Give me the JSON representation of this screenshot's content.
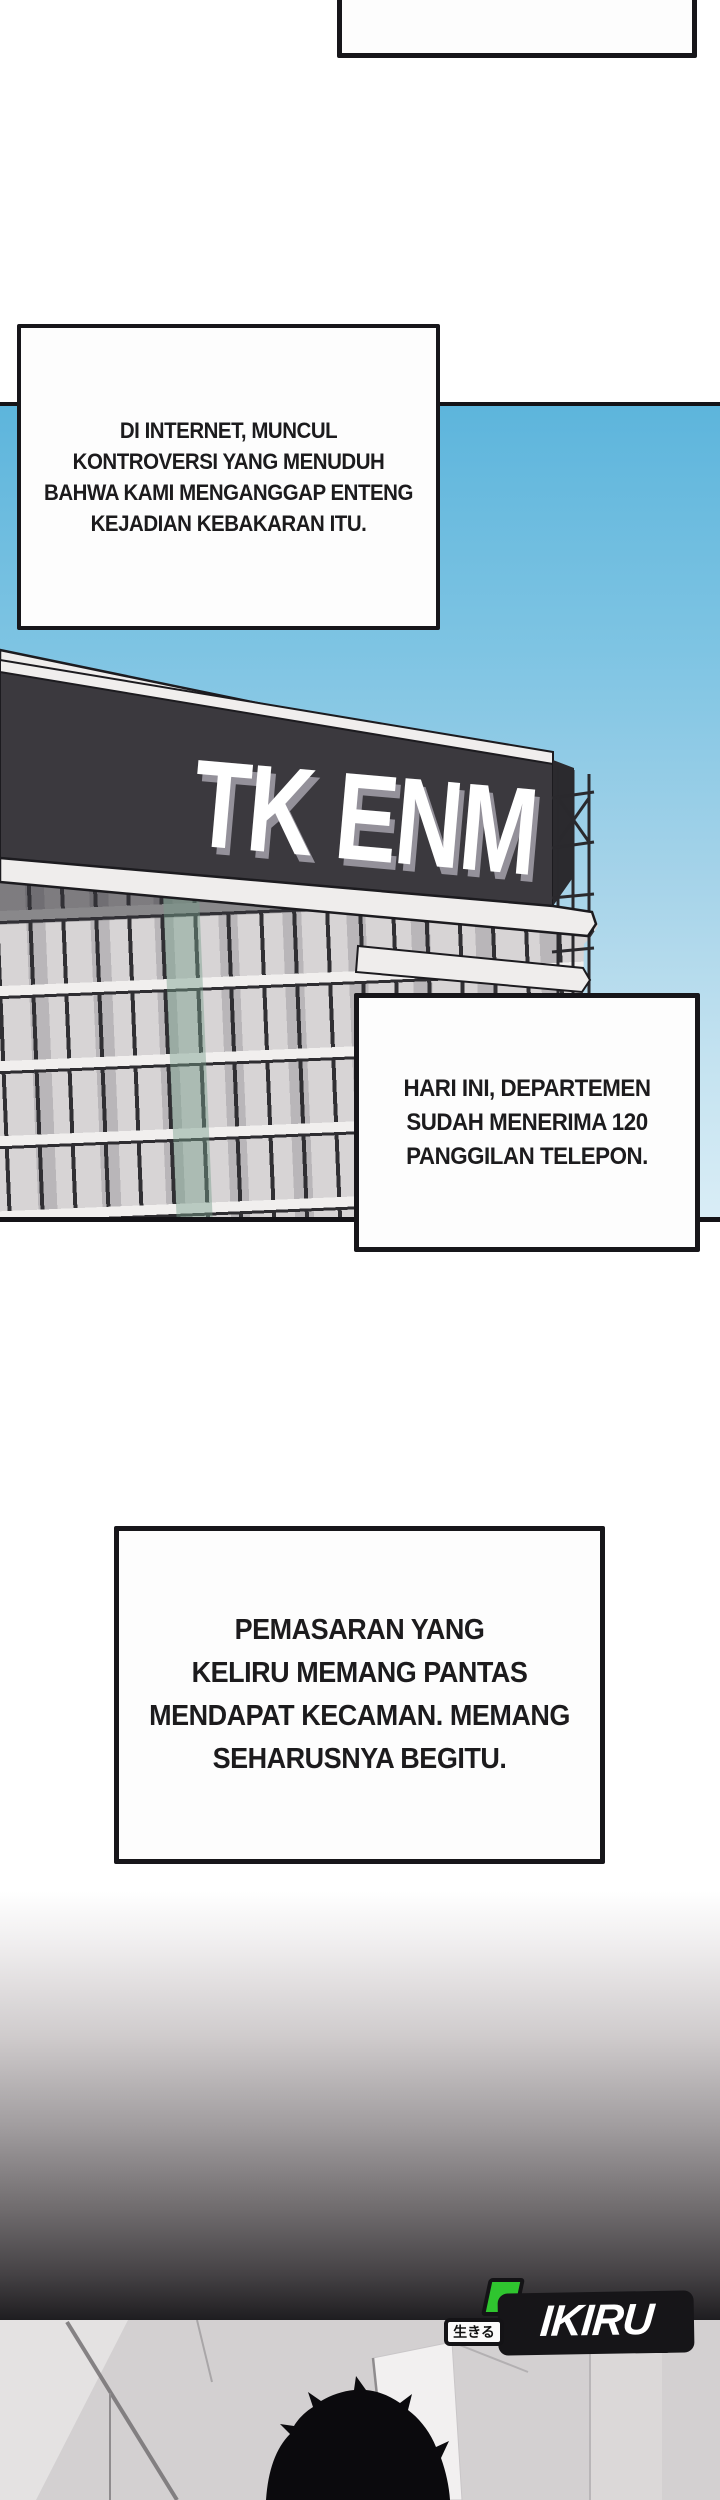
{
  "page": {
    "kind": "webtoon-comic-page"
  },
  "narration": {
    "bubble1": {
      "lines": [
        "DI INTERNET, MUNCUL",
        "KONTROVERSI YANG MENUDUH",
        "BAHWA KAMI MENGANGGAP ENTENG",
        "KEJADIAN KEBAKARAN ITU."
      ]
    },
    "bubble2": {
      "lines": [
        "HARI INI, DEPARTEMEN",
        "SUDAH MENERIMA 120",
        "PANGGILAN TELEPON."
      ]
    },
    "bubble3": {
      "lines": [
        "PEMASARAN YANG",
        "KELIRU MEMANG PANTAS",
        "MENDAPAT KECAMAN. MEMANG",
        "SEHARUSNYA BEGITU."
      ]
    }
  },
  "scene": {
    "building_sign": "TK ENM"
  },
  "logo": {
    "name": "IKIRU",
    "jp": "生きる"
  },
  "colors": {
    "sky_top": "#5db5dc",
    "sky_bottom": "#d9edf6",
    "sign_banner": "#3b393e",
    "bubble_border": "#17161a",
    "logo_green": "#2fc52f",
    "fade_dark": "#1e1d20",
    "bottom_scene_bg": "#d3d0d1"
  }
}
